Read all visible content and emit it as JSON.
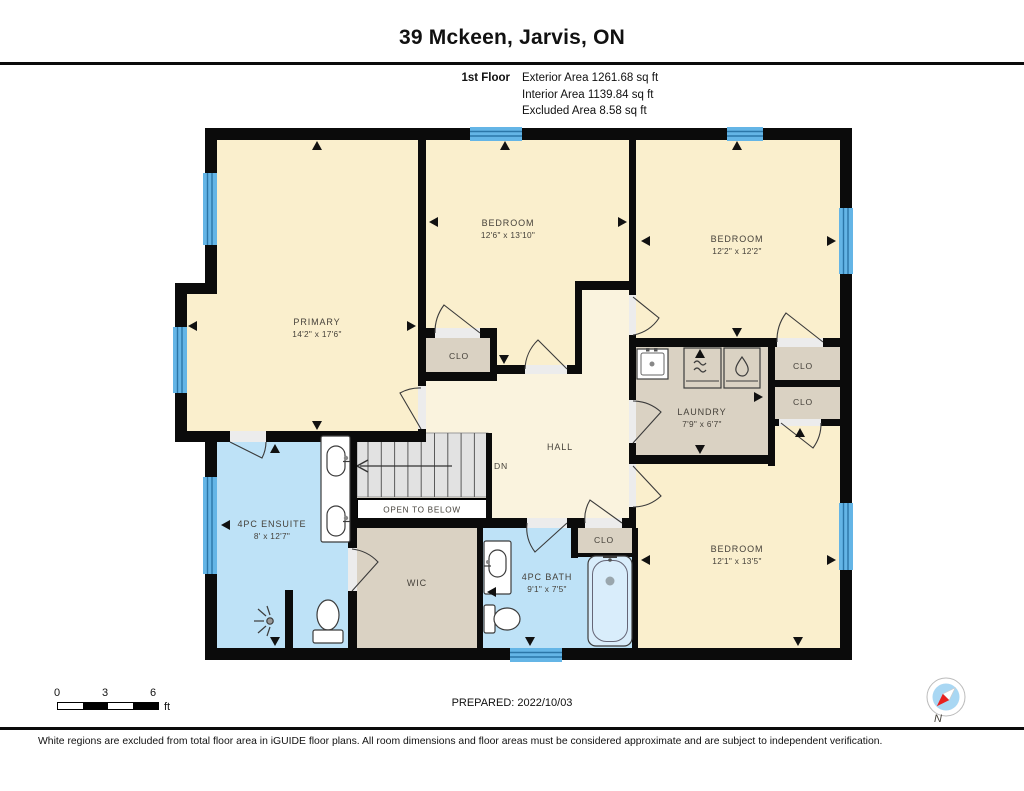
{
  "header": {
    "title": "39 Mckeen, Jarvis, ON"
  },
  "floor_info": {
    "floor_label": "1st Floor",
    "exterior": "Exterior Area 1261.68 sq ft",
    "interior": "Interior Area 1139.84 sq ft",
    "excluded": "Excluded Area 8.58 sq ft"
  },
  "rooms": {
    "primary": {
      "name": "PRIMARY",
      "dims": "14'2\" x 17'6\""
    },
    "bedroom_mid": {
      "name": "BEDROOM",
      "dims": "12'6\" x 13'10\""
    },
    "bedroom_right": {
      "name": "BEDROOM",
      "dims": "12'2\" x 12'2\""
    },
    "bedroom_bottom": {
      "name": "BEDROOM",
      "dims": "12'1\" x 13'5\""
    },
    "laundry": {
      "name": "LAUNDRY",
      "dims": "7'9\" x 6'7\""
    },
    "ensuite": {
      "name": "4PC ENSUITE",
      "dims": "8' x 12'7\""
    },
    "bath": {
      "name": "4PC BATH",
      "dims": "9'1\" x 7'5\""
    },
    "wic": {
      "name": "WIC"
    },
    "hall": {
      "name": "HALL"
    },
    "closet": {
      "name": "CLO"
    }
  },
  "stairs": {
    "dn": "DN",
    "open_to_below": "OPEN TO BELOW"
  },
  "scale_bar": {
    "tick0": "0",
    "tick1": "3",
    "tick2": "6",
    "unit": "ft"
  },
  "compass": {
    "north_label": "N"
  },
  "footer": {
    "prepared": "PREPARED: 2022/10/03",
    "disclaimer": "White regions are excluded from total floor area in iGUIDE floor plans. All room dimensions and floor areas must be considered approximate and are subject to independent verification."
  },
  "colors": {
    "wall": "#0b0b0b",
    "room_beige": "#FAEFCD",
    "hall_cream": "#FAF3DE",
    "wet_blue": "#BEE2F7",
    "closet_gray": "#DAD2C3",
    "window_blue": "#64B5E6",
    "stairs_gray": "#E2E2E2",
    "compass_red": "#E8201E"
  }
}
